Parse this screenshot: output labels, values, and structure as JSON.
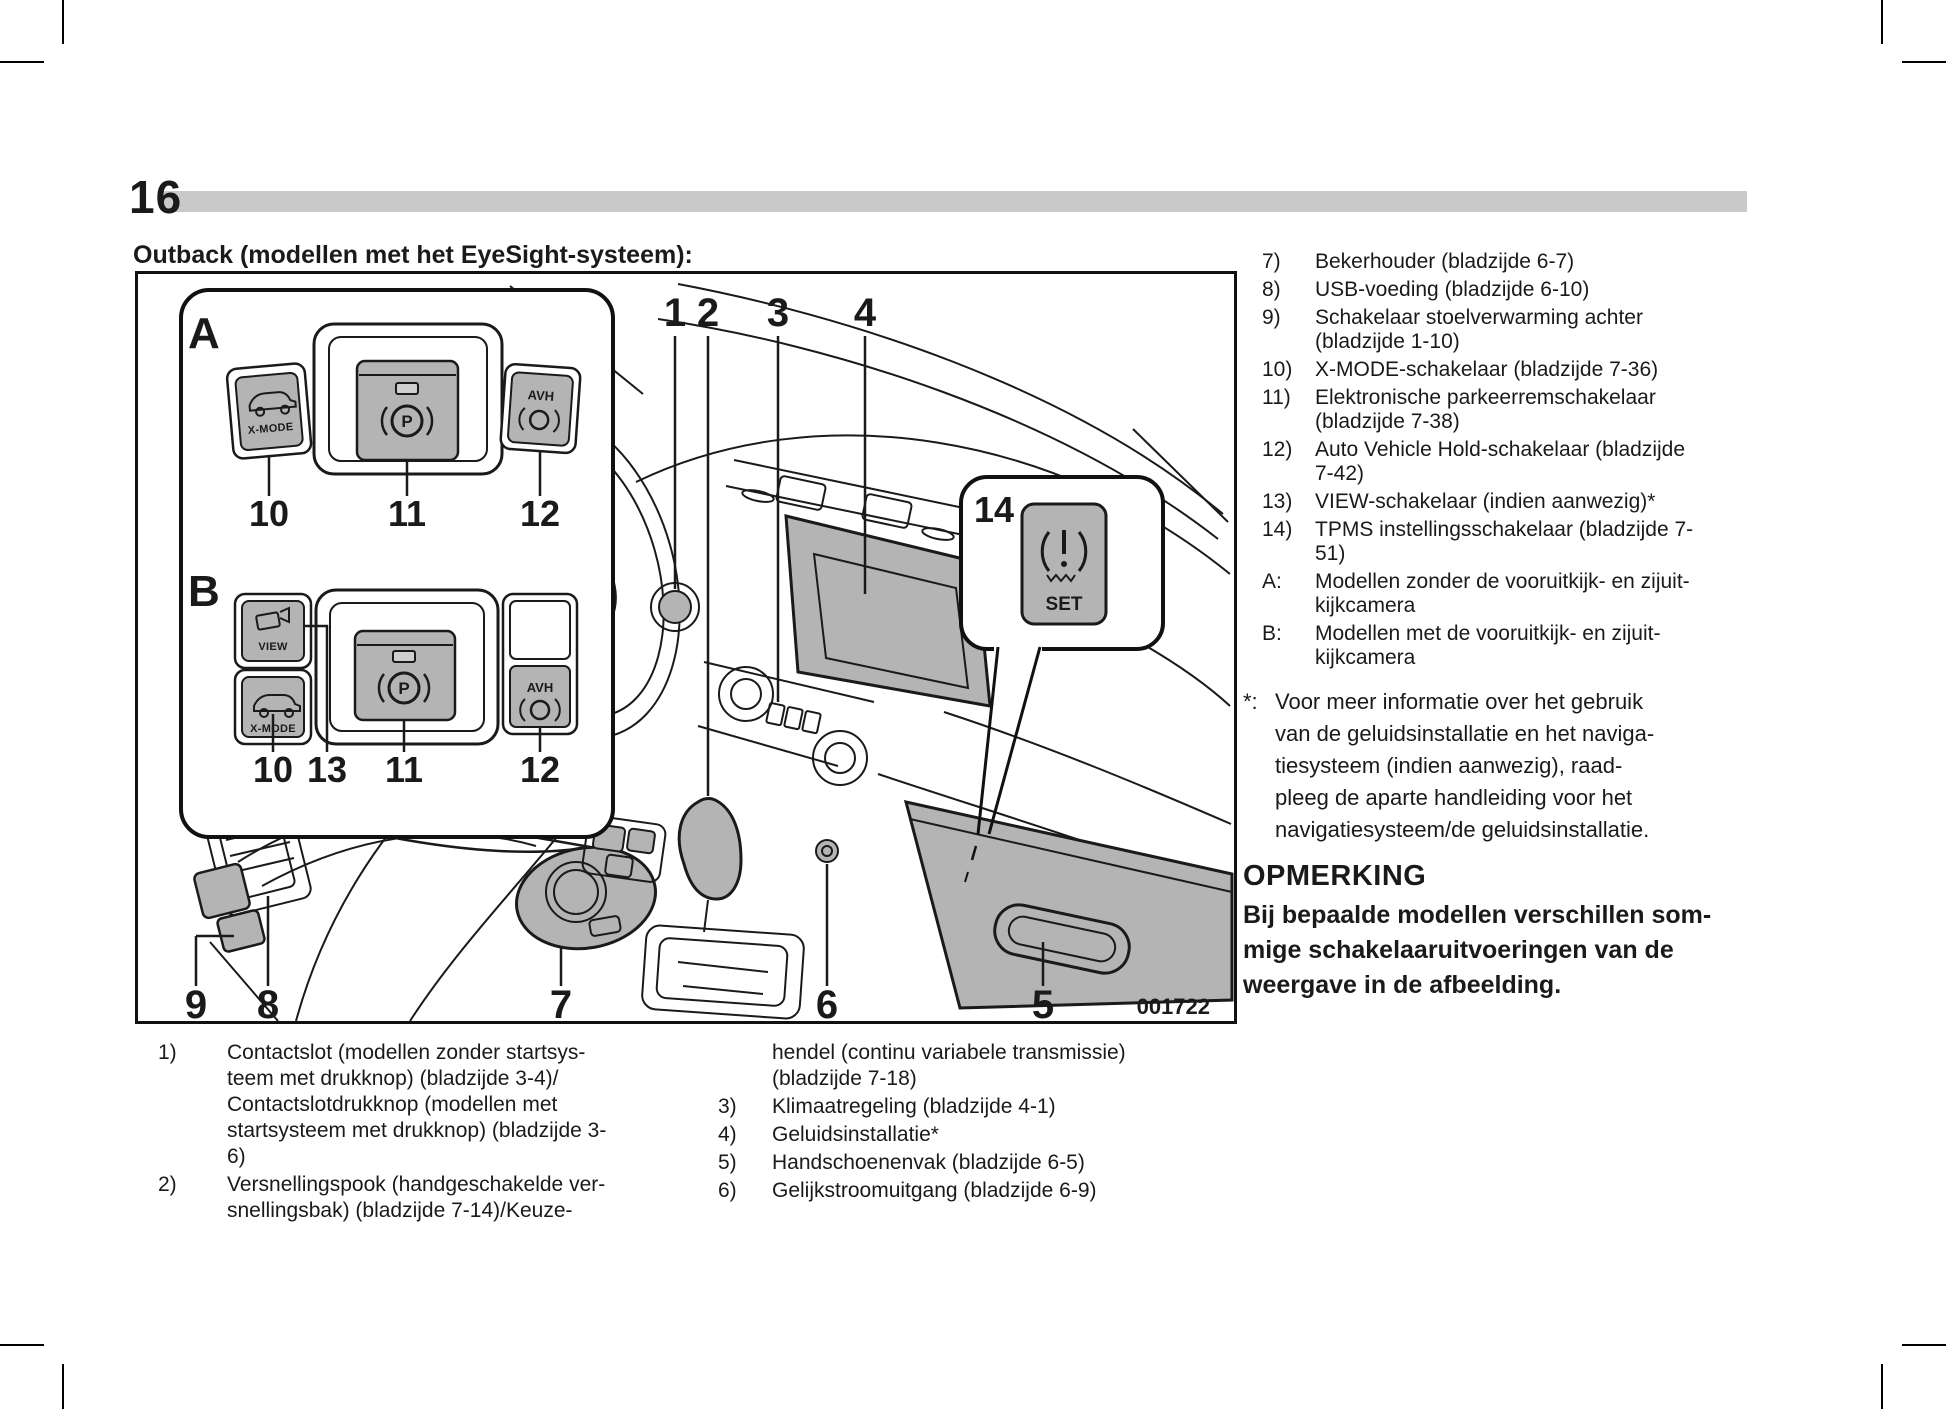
{
  "page_number": "16",
  "section_title": "Outback (modellen met het EyeSight-systeem):",
  "diagram": {
    "figure_code": "001722",
    "top_nums": [
      "1",
      "2",
      "3",
      "4"
    ],
    "bottom_nums": [
      "9",
      "8",
      "7",
      "6",
      "5"
    ],
    "panel_a": {
      "label": "A",
      "xmode": "X-MODE",
      "park": "P",
      "avh": "AVH",
      "nums": [
        "10",
        "11",
        "12"
      ]
    },
    "panel_b": {
      "label": "B",
      "view": "VIEW",
      "xmode": "X-MODE",
      "park": "P",
      "avh": "AVH",
      "nums": [
        "10",
        "13",
        "11",
        "12"
      ]
    },
    "tpms": {
      "num": "14",
      "set": "SET"
    }
  },
  "legend_bottom_left": [
    {
      "num": "1)",
      "text": "Contactslot (modellen zonder startsys-\nteem met drukknop) (bladzijde 3-4)/\nContactslotdrukknop (modellen met\nstartsysteem met drukknop) (bladzijde 3-\n6)"
    },
    {
      "num": "2)",
      "text": "Versnellingspook (handgeschakelde ver-\nsnellingsbak) (bladzijde 7-14)/Keuze-"
    }
  ],
  "legend_bottom_right": [
    {
      "num": "",
      "text": "hendel (continu variabele transmissie)\n(bladzijde 7-18)"
    },
    {
      "num": "3)",
      "text": "Klimaatregeling (bladzijde 4-1)"
    },
    {
      "num": "4)",
      "text": "Geluidsinstallatie*"
    },
    {
      "num": "5)",
      "text": "Handschoenenvak (bladzijde 6-5)"
    },
    {
      "num": "6)",
      "text": "Gelijkstroomuitgang (bladzijde 6-9)"
    }
  ],
  "legend_right": [
    {
      "num": "7)",
      "text": "Bekerhouder (bladzijde 6-7)"
    },
    {
      "num": "8)",
      "text": "USB-voeding (bladzijde 6-10)"
    },
    {
      "num": "9)",
      "text": "Schakelaar stoelverwarming achter\n(bladzijde 1-10)"
    },
    {
      "num": "10)",
      "text": "X-MODE-schakelaar (bladzijde 7-36)"
    },
    {
      "num": "11)",
      "text": "Elektronische parkeerremschakelaar\n(bladzijde 7-38)"
    },
    {
      "num": "12)",
      "text": "Auto Vehicle Hold-schakelaar (bladzijde\n7-42)"
    },
    {
      "num": "13)",
      "text": "VIEW-schakelaar (indien aanwezig)*"
    },
    {
      "num": "14)",
      "text": "TPMS instellingsschakelaar (bladzijde 7-\n51)"
    },
    {
      "num": "A:",
      "text": "Modellen zonder de vooruitkijk- en zijuit-\nkijkcamera"
    },
    {
      "num": "B:",
      "text": "Modellen met de vooruitkijk- en zijuit-\nkijkcamera"
    }
  ],
  "footnote": {
    "num": "*:",
    "text": "Voor meer informatie over het gebruik\nvan de geluidsinstallatie en het naviga-\ntiesysteem (indien aanwezig), raad-\npleeg de aparte handleiding voor het\nnavigatiesysteem/de geluidsinstallatie."
  },
  "note": {
    "heading": "OPMERKING",
    "body": "Bij bepaalde modellen verschillen som-\nmige schakelaaruitvoeringen van de\nweergave in de afbeelding."
  },
  "colors": {
    "button_gray": "#b4b4b4",
    "header_bar": "#c9c9c9",
    "ink": "#1a1a1a"
  }
}
